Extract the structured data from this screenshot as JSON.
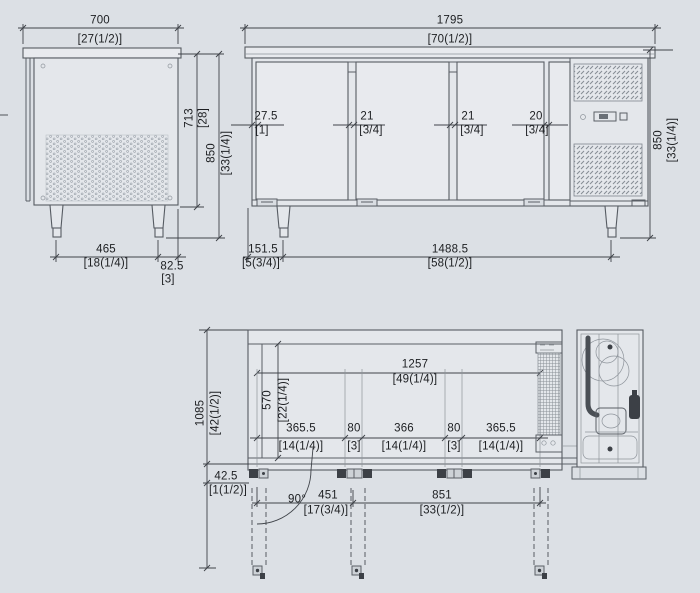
{
  "colors": {
    "background": "#dce0e5",
    "line": "#565b62",
    "dim_text": "#1c1e21"
  },
  "views": {
    "side": {
      "width_mm": "700",
      "width_in": "[27(1/2)]",
      "body_height_mm": "713",
      "body_height_in": "[28]",
      "height_mm": "850",
      "height_in": "[33(1/4)]",
      "leg_span_mm": "465",
      "leg_span_in": "[18(1/4)]",
      "leg_offset_mm": "82.5",
      "leg_offset_in": "[3]"
    },
    "front": {
      "width_mm": "1795",
      "width_in": "[70(1/2)]",
      "gap_left_mm": "27.5",
      "gap_left_in": "[1]",
      "gap_mid1_mm": "21",
      "gap_mid1_in": "[3/4]",
      "gap_mid2_mm": "21",
      "gap_mid2_in": "[3/4]",
      "gap_right_mm": "20",
      "gap_right_in": "[3/4]",
      "height_mm": "850",
      "height_in": "[33(1/4)]",
      "leg_offset_mm": "151.5",
      "leg_offset_in": "[5(3/4)]",
      "leg_span_mm": "1488.5",
      "leg_span_in": "[58(1/2)]"
    },
    "plan": {
      "depth_mm": "1085",
      "depth_in": "[42(1/2)]",
      "interior_depth_mm": "570",
      "interior_depth_in": "[22(1/4)]",
      "hinge_span_mm": "1257",
      "hinge_span_in": "[49(1/4)]",
      "seg1_mm": "365.5",
      "seg1_in": "[14(1/4)]",
      "seg2_mm": "80",
      "seg2_in": "[3]",
      "seg3_mm": "366",
      "seg3_in": "[14(1/4)]",
      "seg4_mm": "80",
      "seg4_in": "[3]",
      "seg5_mm": "365.5",
      "seg5_in": "[14(1/4)]",
      "hinge_offset_mm": "42.5",
      "hinge_offset_in": "[1(1/2)]",
      "door_angle": "90°",
      "swing1_mm": "451",
      "swing1_in": "[17(3/4)]",
      "swing2_mm": "851",
      "swing2_in": "[33(1/2)]"
    }
  }
}
